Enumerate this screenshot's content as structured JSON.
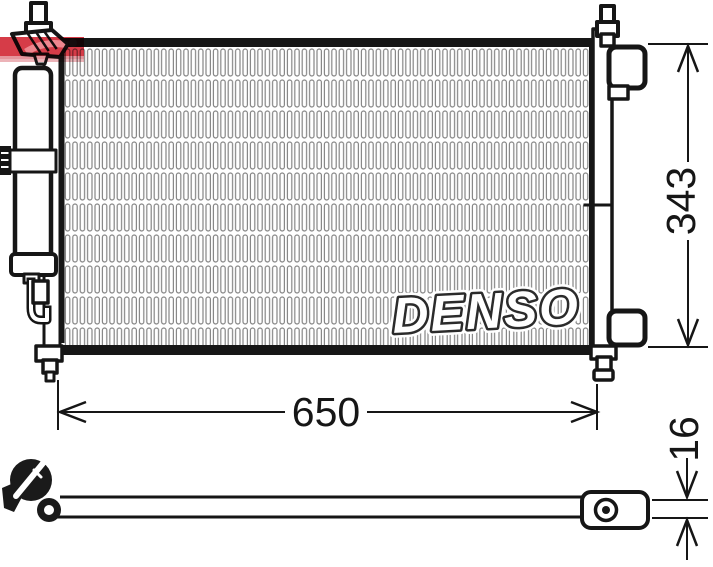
{
  "dimensions": {
    "width_mm": "650",
    "height_mm": "343",
    "thickness_mm": "16"
  },
  "watermarks": {
    "brand": "DENSO",
    "stamp_color": "#d0212f"
  },
  "colors": {
    "line": "#161616",
    "fin_stroke": "#858585",
    "background": "#ffffff"
  }
}
